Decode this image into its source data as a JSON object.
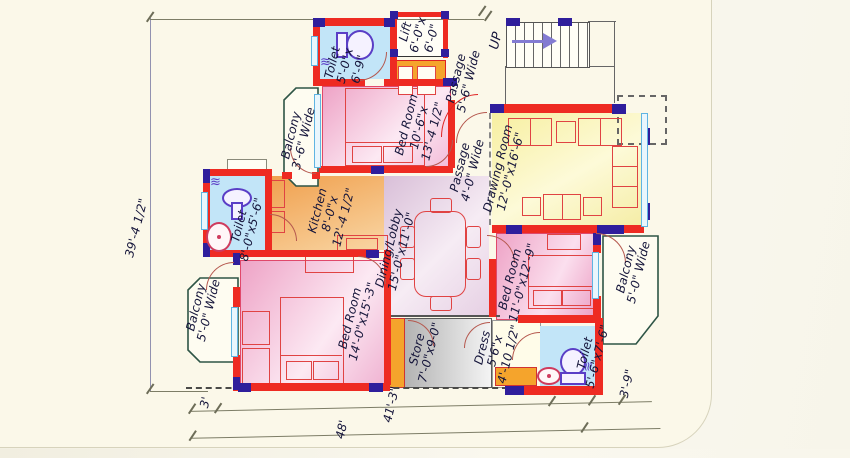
{
  "rooms": {
    "toilet_top": [
      "Toilet",
      "5'-0\"x",
      "6'-9\""
    ],
    "lift": [
      "Lift",
      "6'-0\"x",
      "6'-0\""
    ],
    "passage_top": [
      "Passage",
      "5'-6\" Wide"
    ],
    "stairs_label": "UP",
    "balcony_top_left": [
      "Balcony",
      "3'-6\" Wide"
    ],
    "bed_room_top": [
      "Bed Room",
      "10'-6\"x",
      "13'-4 1/2\""
    ],
    "drawing_room": [
      "Drawing Room",
      "12'-0\"x16'-6\""
    ],
    "passage_mid": [
      "Passage",
      "4'-0\" Wide"
    ],
    "toilet_left": [
      "Toilet",
      "8'-0\"x5'-6\""
    ],
    "kitchen": [
      "Kitchen",
      "8'-0\"x",
      "12'-4 1/2\""
    ],
    "dining_lobby": [
      "Dining/Lobby",
      "15'-0\"x11'-0\""
    ],
    "balcony_left": [
      "Balcony",
      "5'-0\" Wide"
    ],
    "bed_room_left": [
      "Bed Room",
      "14'-0\"x15'-3\""
    ],
    "store": [
      "Store",
      "7'-0\"x9-0\""
    ],
    "dress": [
      "Dress",
      "5'6\"x",
      "4'-10 1/2\""
    ],
    "bed_room_right": [
      "Bed Room",
      "11'-0\"x12'-9\""
    ],
    "toilet_bottom_right": [
      "Toilet",
      "5'-6\"x7'-6\""
    ],
    "balcony_right": [
      "Balcony",
      "5'-0\" Wide"
    ]
  },
  "dimensions": {
    "left_height": "39'-4 1/2\"",
    "bottom_offset_left": "3'",
    "bottom_total": "48'",
    "bottom_inner": "41'-3\"",
    "bottom_offset_right": "3'-9\""
  },
  "colors": {
    "wall_red": "#ee2b22",
    "column_indigo": "#2f1e9c",
    "window_blue": "#5fb4e2",
    "bedroom_pink": "#f3aed0",
    "drawing_yellow": "#faf3a6",
    "kitchen_orange": "#f4a54f",
    "toilet_blue": "#c2e5f8",
    "store_grey": "#c9c9c9",
    "dining_mauve": "#dcc3da",
    "fixture_purple": "#5a3ec6",
    "paper_cream": "#fbf8e9"
  }
}
